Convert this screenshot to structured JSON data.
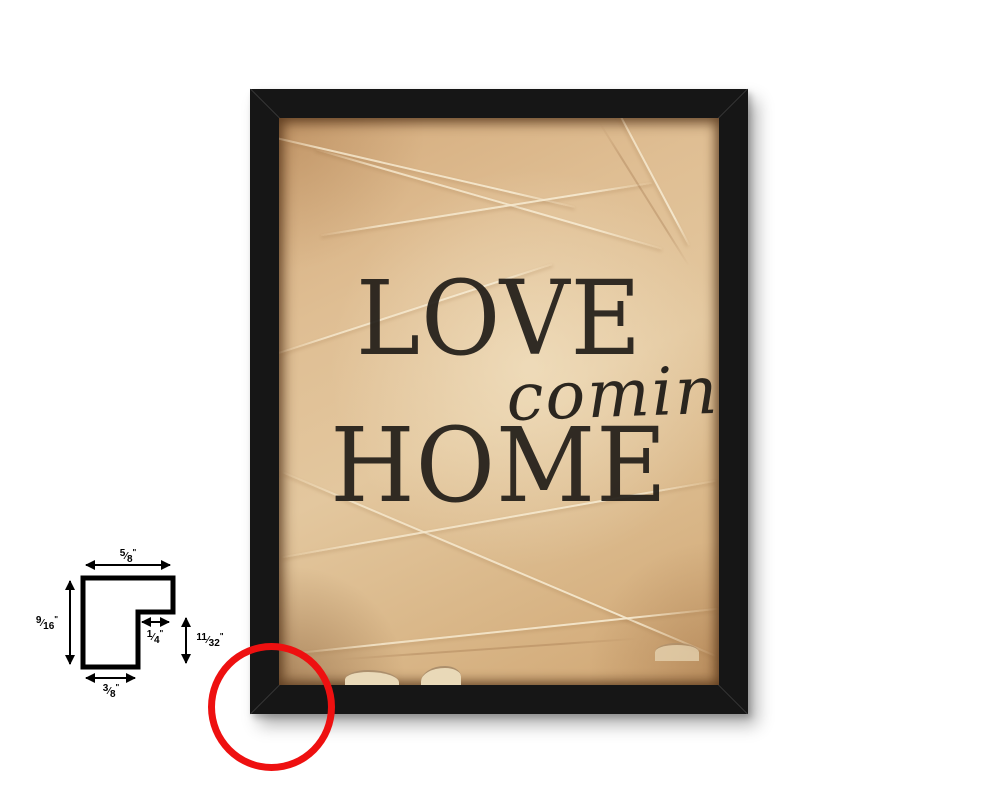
{
  "artwork": {
    "line1": "LOVE",
    "line2": "coming",
    "line3": "HOME"
  },
  "frame": {
    "color": "#161616",
    "paper_base_color": "#dfbe93",
    "text_color": "#211d18"
  },
  "diagram": {
    "slash": "⁄",
    "unit": "\"",
    "dims": {
      "top": {
        "num": "5",
        "den": "8"
      },
      "left": {
        "num": "9",
        "den": "16"
      },
      "rabbet_width": {
        "num": "1",
        "den": "4"
      },
      "rabbet_depth": {
        "num": "11",
        "den": "32"
      },
      "bottom": {
        "num": "3",
        "den": "8"
      }
    }
  },
  "highlight": {
    "circle_color": "#ee1010"
  }
}
